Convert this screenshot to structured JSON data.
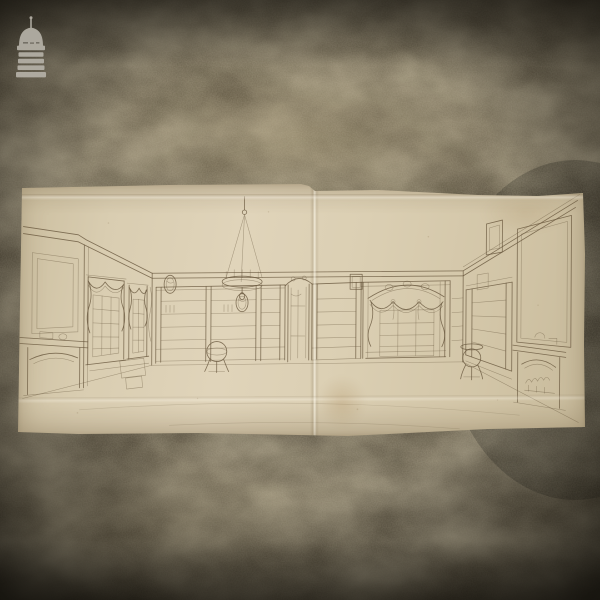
{
  "scene": {
    "description": "Photograph of an antique pen-and-ink perspective drawing of a panelled Georgian library interior, laid flat on a dark mottled stone floor",
    "stone_base_color": "#4a4232",
    "vignette_color": "#0b0903"
  },
  "watermark": {
    "icon_name": "cupola-logo-icon",
    "color": "#b5b1a7"
  },
  "paper": {
    "color": "#dccfb4",
    "ink_color": "#6a5940",
    "creases": [
      "vertical-center-fold",
      "top-horizontal-crease",
      "lower-horizontal-crease"
    ]
  },
  "drawing": {
    "subject": "Georgian library interior perspective",
    "features": [
      "fireplace with overmantel panel on left wall",
      "two sash windows with swagged drapery",
      "oval portrait medallions",
      "hanging chandelier on chains",
      "bookcases along rear wall",
      "central ornamented doorway",
      "arched alcove with swag curtains and glazing",
      "globe on stand",
      "pedestal table",
      "fireplace with arched grate and tall overmantel on right wall"
    ]
  }
}
